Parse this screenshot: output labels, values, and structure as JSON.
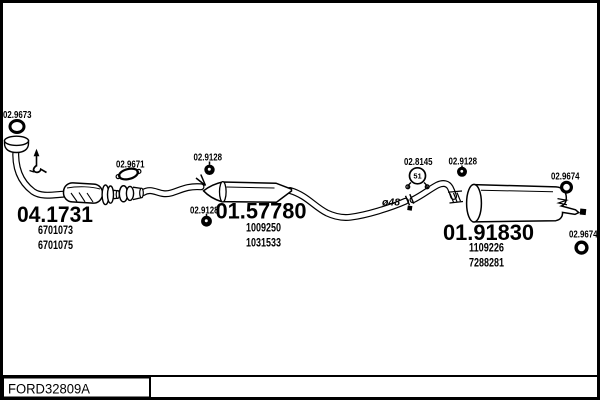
{
  "colors": {
    "background": "#ffffff",
    "line": "#000000",
    "text": "#000000"
  },
  "footer": {
    "code": "FORD32809A"
  },
  "callouts": {
    "front_gasket": "02.9673",
    "mid_gasket": "02.9671",
    "hanger_front": "02.9128",
    "hanger_centre": "02.9128",
    "hanger_rear": "02.9128",
    "clamp": "02.8145",
    "clamp_size": "51",
    "ring_upper": "02.9674",
    "ring_lower": "02.9674",
    "pipe_diameter": "ø48"
  },
  "parts": {
    "front_pipe": {
      "number": "04.1731",
      "oe_numbers": [
        "6701073",
        "6701075"
      ]
    },
    "centre_silencer": {
      "number": "01.57780",
      "oe_numbers": [
        "1009250",
        "1031533"
      ]
    },
    "rear_silencer": {
      "number": "01.91830",
      "oe_numbers": [
        "1109226",
        "7288281"
      ]
    }
  },
  "icons": {
    "front_gasket": "o-ring",
    "mid_gasket": "flange-gasket",
    "hangers": "rubber-mount-dot",
    "clamp": "pipe-clamp",
    "rings": "rubber-ring",
    "mounting_point": "arrow-up-hanger"
  }
}
